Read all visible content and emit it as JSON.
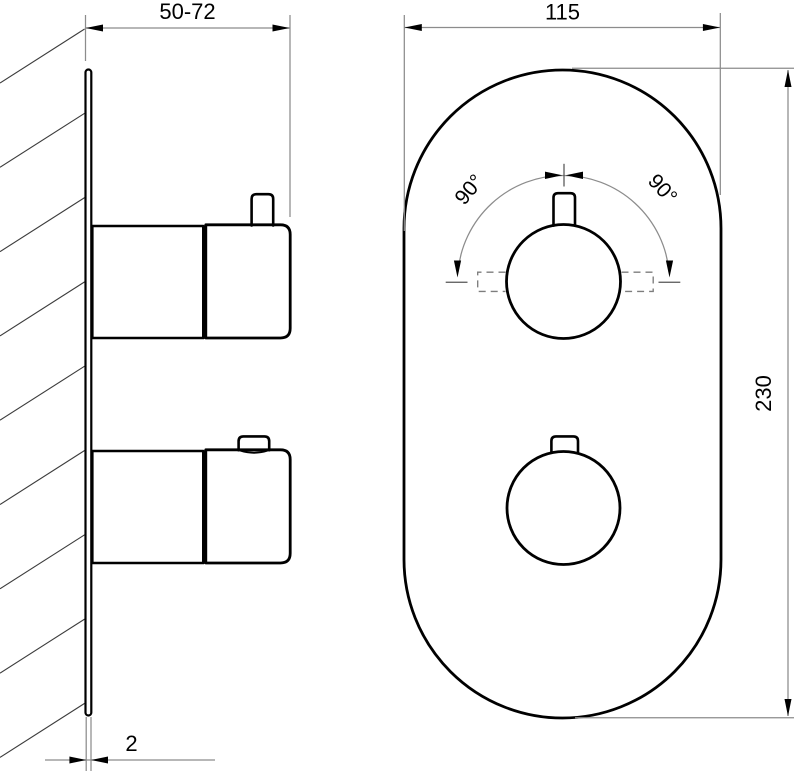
{
  "labels": {
    "side_view": {
      "depth_range": "50-72",
      "plate_thickness": "2"
    },
    "front_view": {
      "plate_width": "115",
      "plate_height": "230",
      "handle_rotation_left": "90°",
      "handle_rotation_right": "90°"
    }
  },
  "colors": {
    "object_line": "#000000",
    "dimension_line": "#8c8c8c",
    "background": "#ffffff"
  }
}
